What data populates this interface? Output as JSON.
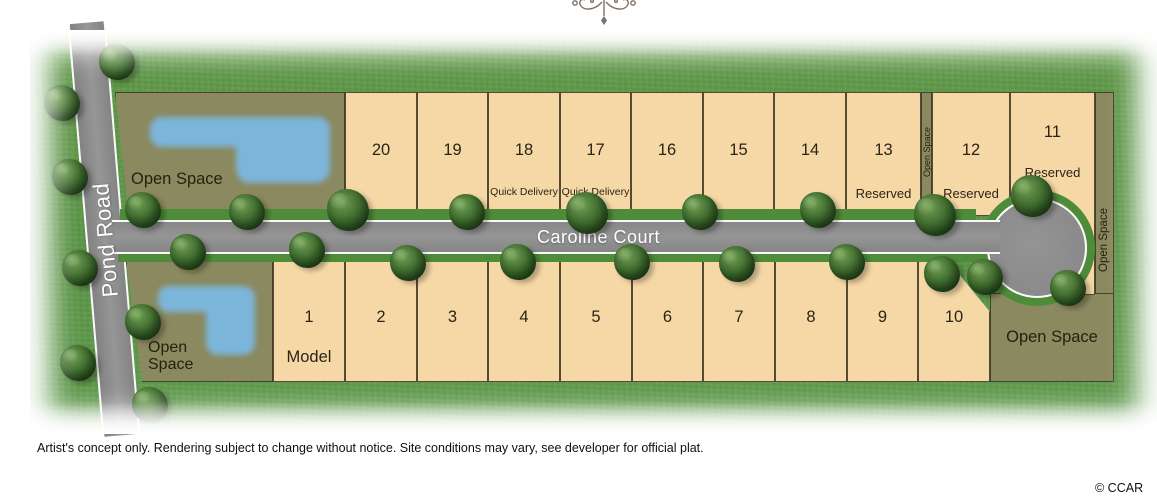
{
  "map": {
    "streets": {
      "vertical": "Pond Road",
      "main": "Caroline Court"
    },
    "open_spaces": {
      "upper_left": "Open Space",
      "lower_left_line1": "Open",
      "lower_left_line2": "Space",
      "mid_strip": "Open Space",
      "right_strip": "Open Space",
      "lower_right": "Open Space"
    },
    "lots": {
      "top_row": [
        {
          "number": "20",
          "note": ""
        },
        {
          "number": "19",
          "note": ""
        },
        {
          "number": "18",
          "note": "Quick Delivery"
        },
        {
          "number": "17",
          "note": "Quick Delivery"
        },
        {
          "number": "16",
          "note": ""
        },
        {
          "number": "15",
          "note": ""
        },
        {
          "number": "14",
          "note": ""
        },
        {
          "number": "13",
          "note": "Reserved"
        },
        {
          "number": "12",
          "note": "Reserved"
        },
        {
          "number": "11",
          "note": "Reserved"
        }
      ],
      "bottom_row": [
        {
          "number": "1",
          "note": "Model"
        },
        {
          "number": "2",
          "note": ""
        },
        {
          "number": "3",
          "note": ""
        },
        {
          "number": "4",
          "note": ""
        },
        {
          "number": "5",
          "note": ""
        },
        {
          "number": "6",
          "note": ""
        },
        {
          "number": "7",
          "note": ""
        },
        {
          "number": "8",
          "note": ""
        },
        {
          "number": "9",
          "note": ""
        },
        {
          "number": "10",
          "note": ""
        }
      ]
    }
  },
  "footer": {
    "disclaimer": "Artist's concept only. Rendering subject to change without notice.  Site conditions may vary, see developer for official plat.",
    "credit": "© CCAR"
  },
  "colors": {
    "grass": "#5e9849",
    "verge": "#4f8c3a",
    "road": "#8d8d8d",
    "road_line": "#ffffff",
    "lot_fill": "#f6d8a6",
    "open_space": "#8b895f",
    "pond": "#7cb5da"
  }
}
